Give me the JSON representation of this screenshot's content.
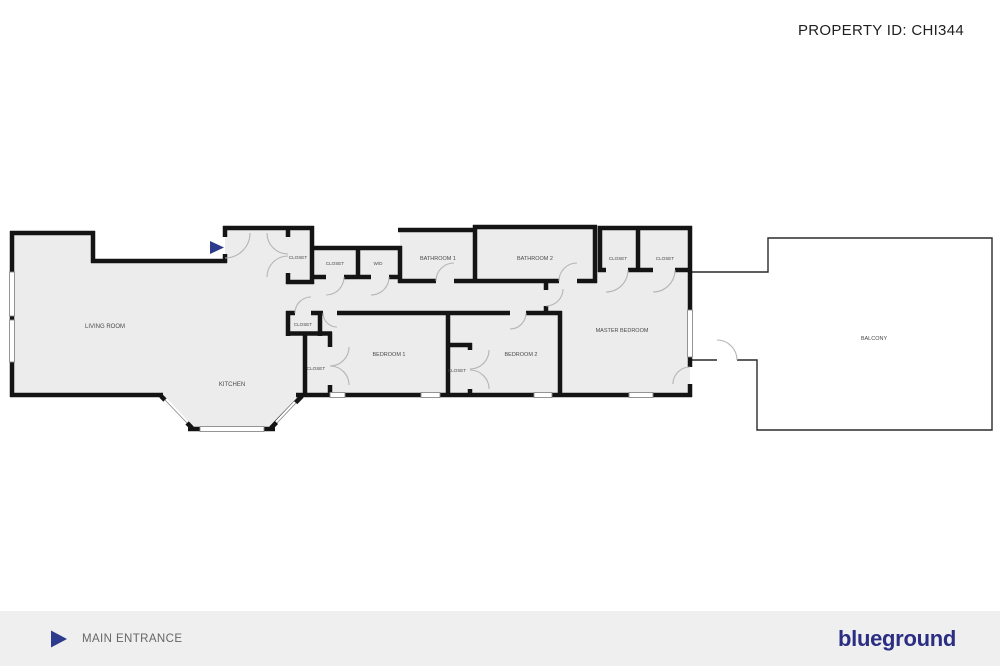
{
  "header": {
    "property_id": "PROPERTY ID: CHI344"
  },
  "floorplan": {
    "rooms": [
      {
        "label": "LIVING ROOM"
      },
      {
        "label": "KITCHEN"
      },
      {
        "label": "CLOSET"
      },
      {
        "label": "CLOSET"
      },
      {
        "label": "W/D"
      },
      {
        "label": "BATHROOM 1"
      },
      {
        "label": "BATHROOM 2"
      },
      {
        "label": "CLOSET"
      },
      {
        "label": "CLOSET"
      },
      {
        "label": "CLOSET"
      },
      {
        "label": "CLOSET"
      },
      {
        "label": "BEDROOM 1"
      },
      {
        "label": "CLOSET"
      },
      {
        "label": "BEDROOM 2"
      },
      {
        "label": "MASTER BEDROOM"
      },
      {
        "label": "BALCONY"
      }
    ]
  },
  "footer": {
    "entrance_label": "MAIN ENTRANCE",
    "brand": "blueground"
  },
  "colors": {
    "wall": "#141414",
    "room_fill": "#ececec",
    "door_arc": "#b5b5b5",
    "window_stroke": "#8a8a8a",
    "balcony_stroke": "#2a2a2a",
    "accent_navy": "#2e3a8c",
    "brand_navy": "#2b2e83",
    "footer_bg": "#efefef",
    "label_text": "#4a4a4a"
  }
}
